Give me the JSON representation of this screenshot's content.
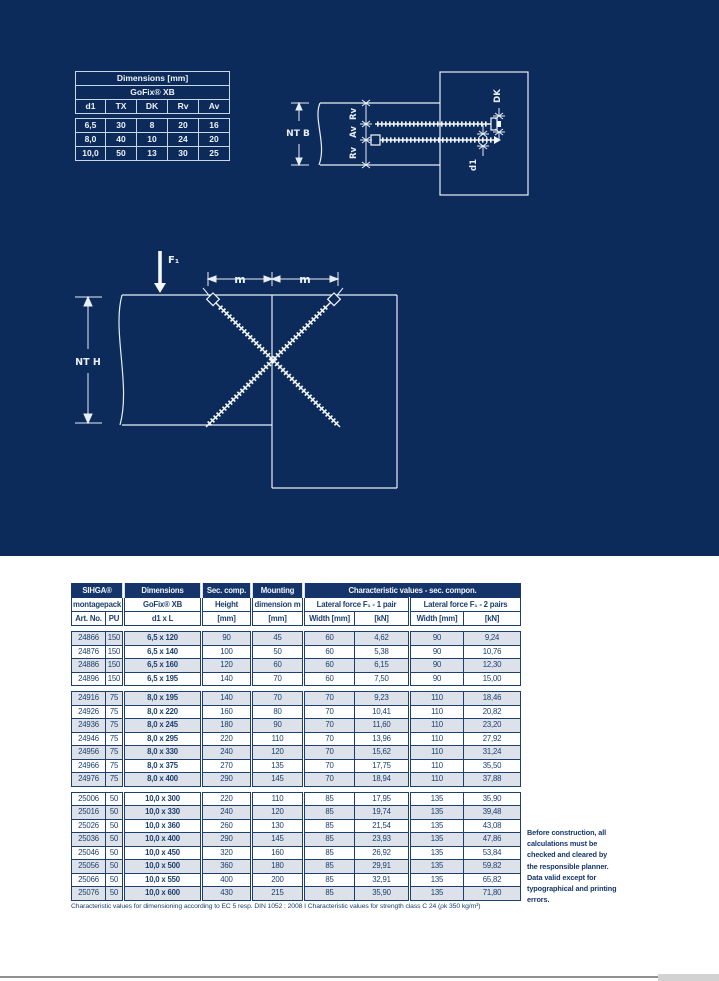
{
  "colors": {
    "navy_background": "#0d2b5a",
    "table_header_navy": "#15356a",
    "row_shaded": "#dde1e9",
    "text_navy": "#1c3f6e",
    "diagram_line": "#e7eef8",
    "mini_table_border": "#c9d6e8"
  },
  "dimensions_table": {
    "title": "Dimensions [mm]",
    "subtitle": "GoFix® XB",
    "columns": [
      "d1",
      "TX",
      "DK",
      "Rv",
      "Av"
    ],
    "rows": [
      [
        "6,5",
        "30",
        "8",
        "20",
        "16"
      ],
      [
        "8,0",
        "40",
        "10",
        "24",
        "20"
      ],
      [
        "10,0",
        "50",
        "13",
        "30",
        "25"
      ]
    ]
  },
  "diagram_fit": {
    "nt_b": "NT B",
    "rv_top": "Rv",
    "av": "Av",
    "rv_bottom": "Rv",
    "dk": "DK",
    "d1": "d1"
  },
  "diagram_load": {
    "f1": "F₁",
    "m_left": "m",
    "m_right": "m",
    "nt_h": "NT H"
  },
  "main_table": {
    "header": {
      "sihga": "SIHGA®",
      "dimensions": "Dimensions",
      "sec_comp": "Sec. comp.",
      "mounting": "Mounting",
      "char_values": "Characteristic values - sec. compon.",
      "montagepack": "montagepack",
      "gofix": "GoFix® XB",
      "height": "Height",
      "dimension_m": "dimension m",
      "lateral_1": "Lateral force F₁ - 1 pair",
      "lateral_2": "Lateral force F₁ - 2 pairs",
      "art_no": "Art. No.",
      "pu": "PU",
      "d1xl": "d1 x L",
      "mm1": "[mm]",
      "mm2": "[mm]",
      "width1": "Width [mm]",
      "kn1": "[kN]",
      "width2": "Width [mm]",
      "kn2": "[kN]"
    },
    "groups": [
      {
        "rows": [
          [
            "24866",
            "150",
            "6,5 x 120",
            "90",
            "45",
            "60",
            "4,62",
            "90",
            "9,24"
          ],
          [
            "24876",
            "150",
            "6,5 x 140",
            "100",
            "50",
            "60",
            "5,38",
            "90",
            "10,76"
          ],
          [
            "24886",
            "150",
            "6,5 x 160",
            "120",
            "60",
            "60",
            "6,15",
            "90",
            "12,30"
          ],
          [
            "24896",
            "150",
            "6,5 x 195",
            "140",
            "70",
            "60",
            "7,50",
            "90",
            "15,00"
          ]
        ]
      },
      {
        "rows": [
          [
            "24916",
            "75",
            "8,0 x 195",
            "140",
            "70",
            "70",
            "9,23",
            "110",
            "18,46"
          ],
          [
            "24926",
            "75",
            "8,0 x 220",
            "160",
            "80",
            "70",
            "10,41",
            "110",
            "20,82"
          ],
          [
            "24936",
            "75",
            "8,0 x 245",
            "180",
            "90",
            "70",
            "11,60",
            "110",
            "23,20"
          ],
          [
            "24946",
            "75",
            "8,0 x 295",
            "220",
            "110",
            "70",
            "13,96",
            "110",
            "27,92"
          ],
          [
            "24956",
            "75",
            "8,0 x 330",
            "240",
            "120",
            "70",
            "15,62",
            "110",
            "31,24"
          ],
          [
            "24966",
            "75",
            "8,0 x 375",
            "270",
            "135",
            "70",
            "17,75",
            "110",
            "35,50"
          ],
          [
            "24976",
            "75",
            "8,0 x 400",
            "290",
            "145",
            "70",
            "18,94",
            "110",
            "37,88"
          ]
        ]
      },
      {
        "rows": [
          [
            "25006",
            "50",
            "10,0 x 300",
            "220",
            "110",
            "85",
            "17,95",
            "135",
            "35,90"
          ],
          [
            "25016",
            "50",
            "10,0 x 330",
            "240",
            "120",
            "85",
            "19,74",
            "135",
            "39,48"
          ],
          [
            "25026",
            "50",
            "10,0 x 360",
            "260",
            "130",
            "85",
            "21,54",
            "135",
            "43,08"
          ],
          [
            "25036",
            "50",
            "10,0 x 400",
            "290",
            "145",
            "85",
            "23,93",
            "135",
            "47,86"
          ],
          [
            "25046",
            "50",
            "10,0 x 450",
            "320",
            "160",
            "85",
            "26,92",
            "135",
            "53,84"
          ],
          [
            "25056",
            "50",
            "10,0 x 500",
            "360",
            "180",
            "85",
            "29,91",
            "135",
            "59,82"
          ],
          [
            "25066",
            "50",
            "10,0 x 550",
            "400",
            "200",
            "85",
            "32,91",
            "135",
            "65,82"
          ],
          [
            "25076",
            "50",
            "10,0 x 600",
            "430",
            "215",
            "85",
            "35,90",
            "135",
            "71,80"
          ]
        ]
      }
    ],
    "footnote": "Characteristic values for dimensioning according to EC 5 resp. DIN 1052 : 2008   I   Characteristic values for strength class C 24 (ρk 350 kg/m³)"
  },
  "side_note": {
    "text": "Before construction, all\ncalculations must be\nchecked and cleared by\nthe responsible planner.\nData valid except for\ntypographical and printing\nerrors."
  }
}
